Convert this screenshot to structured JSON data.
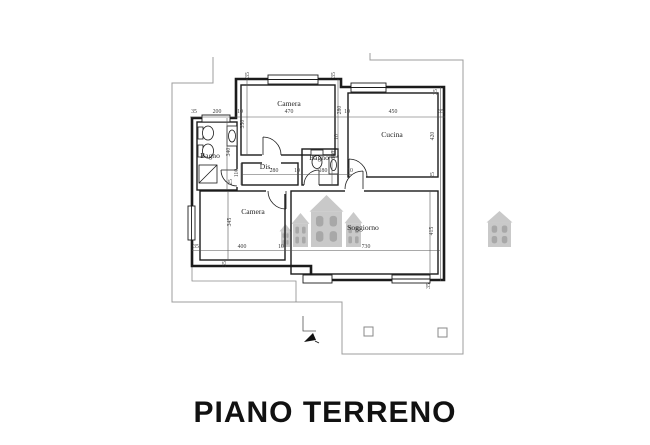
{
  "title": "PIANO TERRENO",
  "colors": {
    "wall": "#1b1b1b",
    "dim": "#3c3c3c",
    "boundary": "#9c9c9c",
    "watermark_body": "#c4c4c4",
    "watermark_window": "#9f9f9f",
    "title": "#111111",
    "background": "#ffffff"
  },
  "floorplan": {
    "room_labels": [
      {
        "label": "Camera",
        "x": 289,
        "y": 106
      },
      {
        "label": "Cucina",
        "x": 392,
        "y": 137
      },
      {
        "label": "Bagno",
        "x": 210,
        "y": 158
      },
      {
        "label": "Dis.",
        "x": 266,
        "y": 169
      },
      {
        "label": "Bagno",
        "x": 319,
        "y": 160
      },
      {
        "label": "Camera",
        "x": 253,
        "y": 214
      },
      {
        "label": "Soggiorno",
        "x": 363,
        "y": 230
      }
    ],
    "dimensions": [
      {
        "v": "35",
        "x": 194,
        "y": 113
      },
      {
        "v": "200",
        "x": 217,
        "y": 113
      },
      {
        "v": "10",
        "x": 240,
        "y": 113
      },
      {
        "v": "470",
        "x": 289,
        "y": 113
      },
      {
        "v": "10",
        "x": 347,
        "y": 113
      },
      {
        "v": "450",
        "x": 393,
        "y": 113
      },
      {
        "v": "35",
        "x": 441,
        "y": 113
      },
      {
        "v": "280",
        "x": 274,
        "y": 172
      },
      {
        "v": "10",
        "x": 297,
        "y": 172
      },
      {
        "v": "180",
        "x": 323,
        "y": 172
      },
      {
        "v": "10",
        "x": 350,
        "y": 172
      },
      {
        "v": "35",
        "x": 196,
        "y": 248
      },
      {
        "v": "400",
        "x": 242,
        "y": 248
      },
      {
        "v": "10",
        "x": 281,
        "y": 248
      },
      {
        "v": "730",
        "x": 366,
        "y": 248
      },
      {
        "v": "35",
        "x": 249,
        "y": 75,
        "rot": true
      },
      {
        "v": "35",
        "x": 335,
        "y": 75,
        "rot": true
      },
      {
        "v": "280",
        "x": 341,
        "y": 110,
        "rot": true
      },
      {
        "v": "350",
        "x": 244,
        "y": 124,
        "rot": true
      },
      {
        "v": "340",
        "x": 230,
        "y": 152,
        "rot": true
      },
      {
        "v": "180",
        "x": 335,
        "y": 155,
        "rot": true
      },
      {
        "v": "10",
        "x": 338,
        "y": 137,
        "rot": true
      },
      {
        "v": "110",
        "x": 238,
        "y": 173,
        "rot": true
      },
      {
        "v": "25",
        "x": 232,
        "y": 182,
        "rot": true
      },
      {
        "v": "345",
        "x": 231,
        "y": 222,
        "rot": true
      },
      {
        "v": "35",
        "x": 226,
        "y": 264,
        "rot": true
      },
      {
        "v": "35",
        "x": 437,
        "y": 92,
        "rot": true
      },
      {
        "v": "420",
        "x": 434,
        "y": 136,
        "rot": true
      },
      {
        "v": "25",
        "x": 434,
        "y": 175,
        "rot": true
      },
      {
        "v": "415",
        "x": 433,
        "y": 231,
        "rot": true
      },
      {
        "v": "35",
        "x": 430,
        "y": 286,
        "rot": true
      }
    ]
  },
  "watermark": {
    "houses": [
      {
        "x": 281,
        "y": 224,
        "w": 9,
        "h": 23
      },
      {
        "x": 293,
        "y": 213,
        "w": 15,
        "h": 34
      },
      {
        "x": 311,
        "y": 195,
        "w": 31,
        "h": 52
      },
      {
        "x": 346,
        "y": 212,
        "w": 15,
        "h": 35
      },
      {
        "x": 488,
        "y": 211,
        "w": 23,
        "h": 36
      }
    ]
  }
}
